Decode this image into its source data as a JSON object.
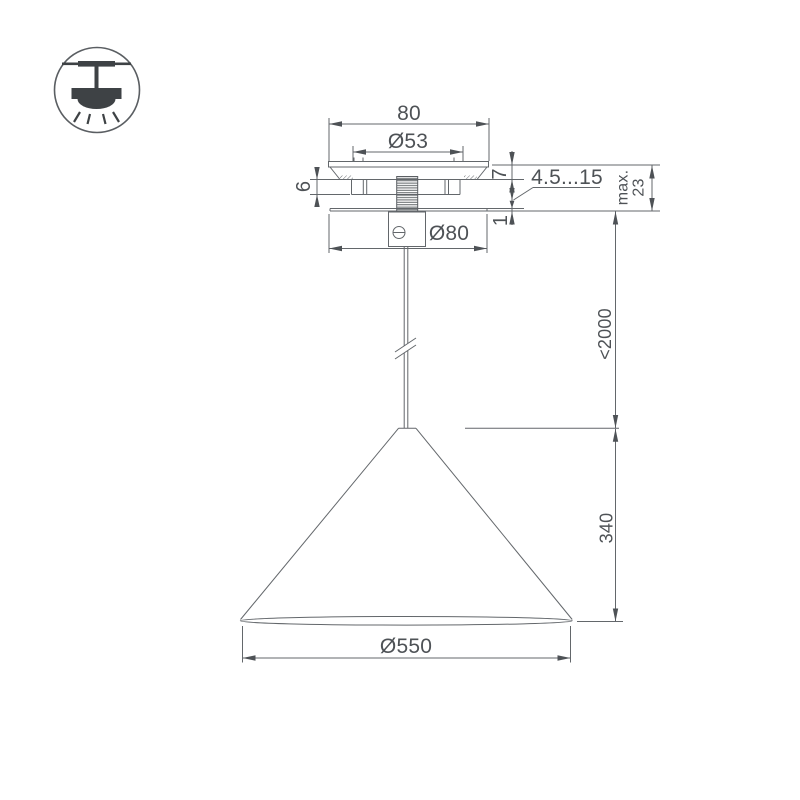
{
  "icon": {
    "type": "pendant-ceiling-lamp-symbol"
  },
  "dims": {
    "top_width": "80",
    "mount_inner_dia": "Ø53",
    "plate_thickness": "7",
    "bracket_height": "6",
    "adjustable_gap": "4.5...15",
    "max_label": "max.",
    "max_value": "23",
    "canopy_plate_thickness": "1",
    "canopy_dia": "Ø80",
    "suspension_length": "<2000",
    "shade_height": "340",
    "shade_dia": "Ø550"
  },
  "colors": {
    "line": "#63676b",
    "text": "#4e5256",
    "icon": "#3e4245",
    "bg": "#ffffff"
  }
}
